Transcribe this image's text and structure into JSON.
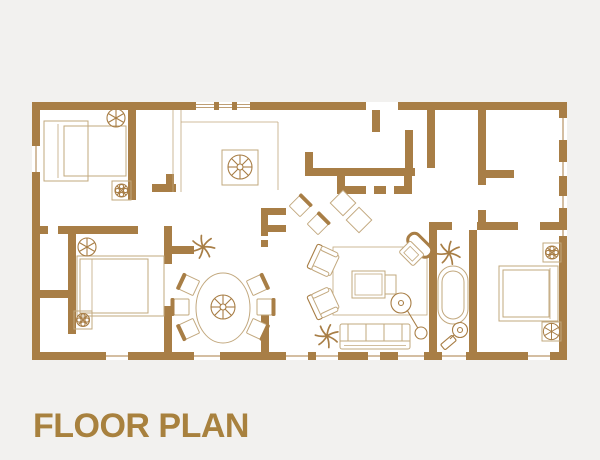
{
  "title": "FLOOR PLAN",
  "colors": {
    "background": "#F2F1EF",
    "floor": "#FFFFFF",
    "wall": "#A87E46",
    "furniture_line": "#C2A87E",
    "title_text": "#A8813E"
  },
  "icons": {
    "ceiling-fan": "circle with radiating spokes",
    "light-fixture": "boxed circle with cross and petals",
    "plant": "radiating palm leaves",
    "bathtub": "double stadium outline",
    "floor-lamp": "shade circle with stem line and base"
  }
}
